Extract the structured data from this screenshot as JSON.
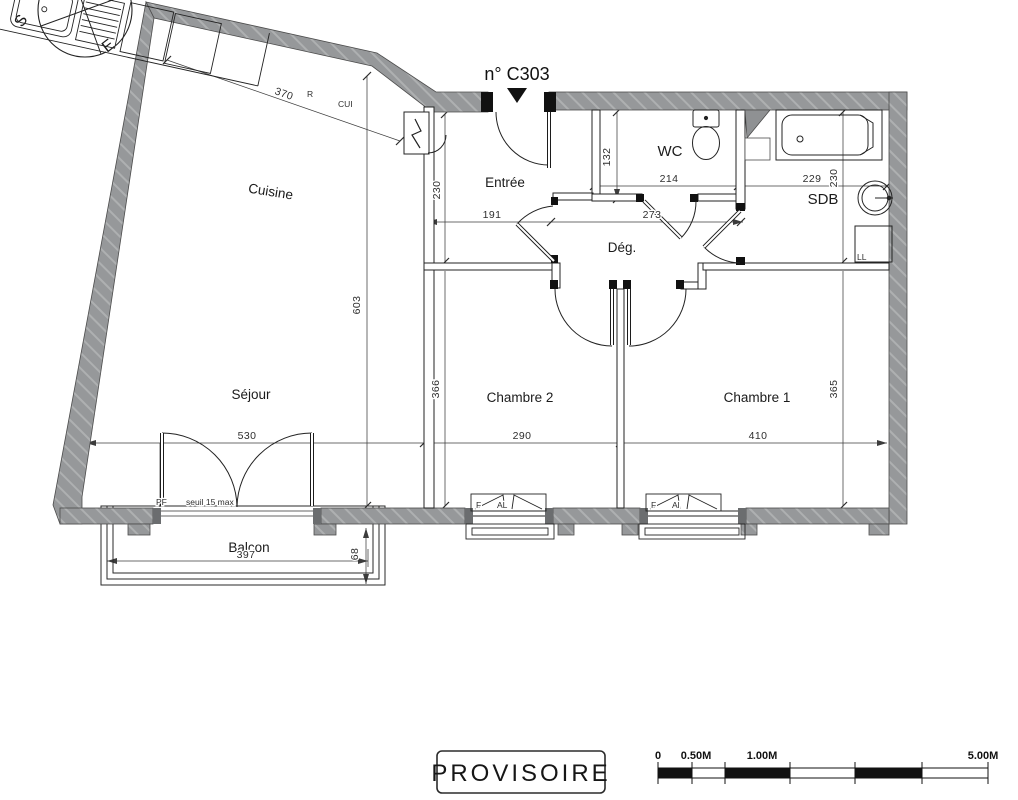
{
  "plan": {
    "unit": "n° C303",
    "rooms": {
      "cuisine": "Cuisine",
      "sejour": "Séjour",
      "entree": "Entrée",
      "wc": "WC",
      "sdb": "SDB",
      "degagement": "Dég.",
      "chambre2": "Chambre 2",
      "chambre1": "Chambre 1",
      "balcon": "Balcon"
    },
    "dims": {
      "kitchen_wall": "370",
      "entree_h": "230",
      "entree_w": "191",
      "wc_h": "132",
      "wc_w": "214",
      "deg_w": "273",
      "sdb_w": "229",
      "sdb_h": "230",
      "sejour_h": "603",
      "sejour_w": "530",
      "ch2_w": "290",
      "ch2_h": "366",
      "ch1_w": "410",
      "ch1_h": "365",
      "balcon_w": "397",
      "balcon_d": "68"
    },
    "fixtures": {
      "fridge": "R",
      "kitchen_col": "CUI",
      "washer": "LL",
      "french_door": "PF",
      "threshold": "seuil 15 max",
      "window1_type": "F",
      "window1_mat": "AL",
      "window2_type": "F",
      "window2_mat": "Al"
    },
    "compass": {
      "south": "S",
      "east": "E"
    }
  },
  "stamp": {
    "label": "PROVISOIRE"
  },
  "scale_bar": {
    "labels": [
      "0",
      "0.50M",
      "1.00M",
      "5.00M"
    ]
  }
}
